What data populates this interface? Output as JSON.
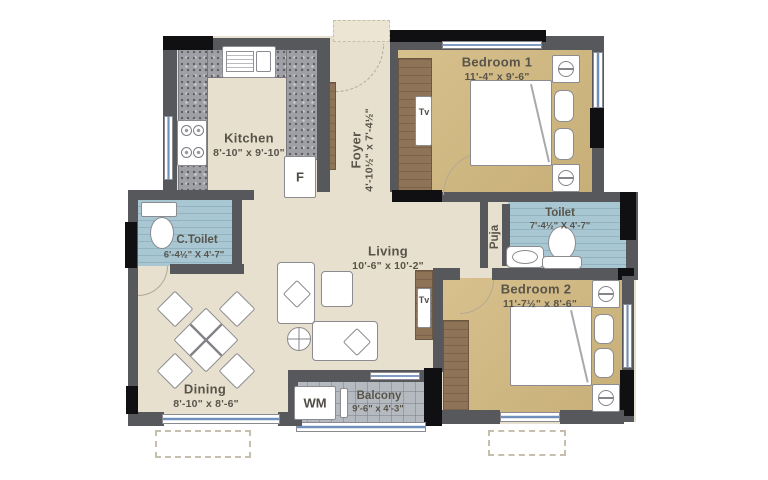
{
  "rooms": {
    "kitchen": {
      "name": "Kitchen",
      "dims": "8'-10\" x 9'-10\""
    },
    "foyer": {
      "name": "Foyer",
      "dims": "4'-10½\" x 7'-4½\""
    },
    "bedroom1": {
      "name": "Bedroom 1",
      "dims": "11'-4\" x 9'-6\""
    },
    "toilet": {
      "name": "Toilet",
      "dims": "7'-4½\" X 4'-7\""
    },
    "puja": {
      "name": "Puja"
    },
    "living": {
      "name": "Living",
      "dims": "10'-6\" x 10'-2\""
    },
    "ctoilet": {
      "name": "C.Toilet",
      "dims": "6'-4½\" X 4'-7\""
    },
    "dining": {
      "name": "Dining",
      "dims": "8'-10\" x 8'-6\""
    },
    "balcony": {
      "name": "Balcony",
      "dims": "9'-6\" x 4'-3\""
    },
    "bedroom2": {
      "name": "Bedroom 2",
      "dims": "11'-7½\" x 8'-6\""
    }
  },
  "appliances": {
    "fridge": "F",
    "washing_machine": "WM",
    "tv_bedroom1": "Tv",
    "tv_living": "Tv"
  },
  "palette": {
    "wall": "#57585c",
    "shaft_black": "#101013",
    "window_blue": "#6f8fbc",
    "floor_cream": "#e7e0ce",
    "floor_bedroom": "#d2b87e",
    "floor_toilet": "#a9c7d3",
    "floor_balcony": "#b5bac0",
    "wood": "#8e7356",
    "granite": "#9fa0a6",
    "label_text": "#58544a"
  }
}
